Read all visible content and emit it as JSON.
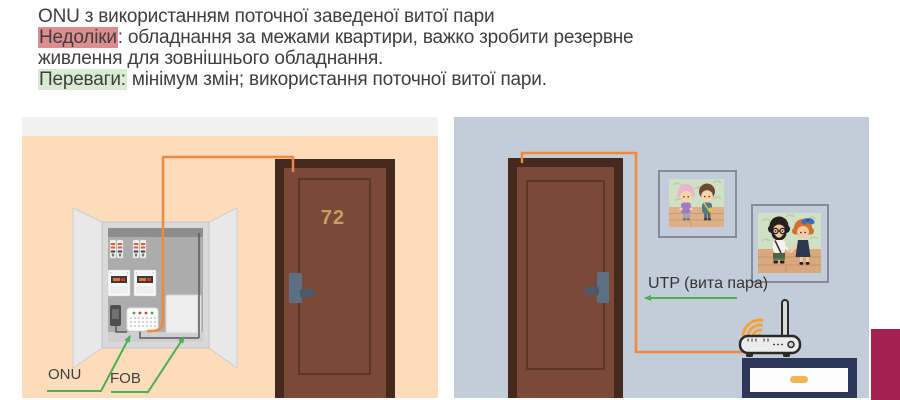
{
  "header": {
    "title": "ONU з використанням поточної заведеної витої пари",
    "cons_label": "Недоліки",
    "cons_text": ": обладнання за межами квартири, важко зробити резервне",
    "cons_text2": "живлення для зовнішнього обладнання.",
    "pros_label": "Переваги:",
    "pros_text": " мінімум змін; використання поточної витої пари."
  },
  "hallway_scene": {
    "door_number": "72",
    "onu_label": "ONU",
    "fob_label": "FOB"
  },
  "apartment_scene": {
    "utp_label": "UTP (вита пара)"
  },
  "colors": {
    "cons_highlight": "#dd8d8d",
    "pros_highlight": "#d8ebd2",
    "hallway_wall": "#fcdcba",
    "hallway_top_strip": "#f1f1f1",
    "apartment_wall": "#c3ccd9",
    "door_brown": "#7a4938",
    "door_frame": "#45291d",
    "cable_orange": "#ef8a3d",
    "arrow_green": "#4caf50",
    "accent_maroon": "#a32051",
    "stand_navy": "#2c3759",
    "wifi_orange": "#f2a338",
    "door_number_gold": "#c79f5e"
  }
}
